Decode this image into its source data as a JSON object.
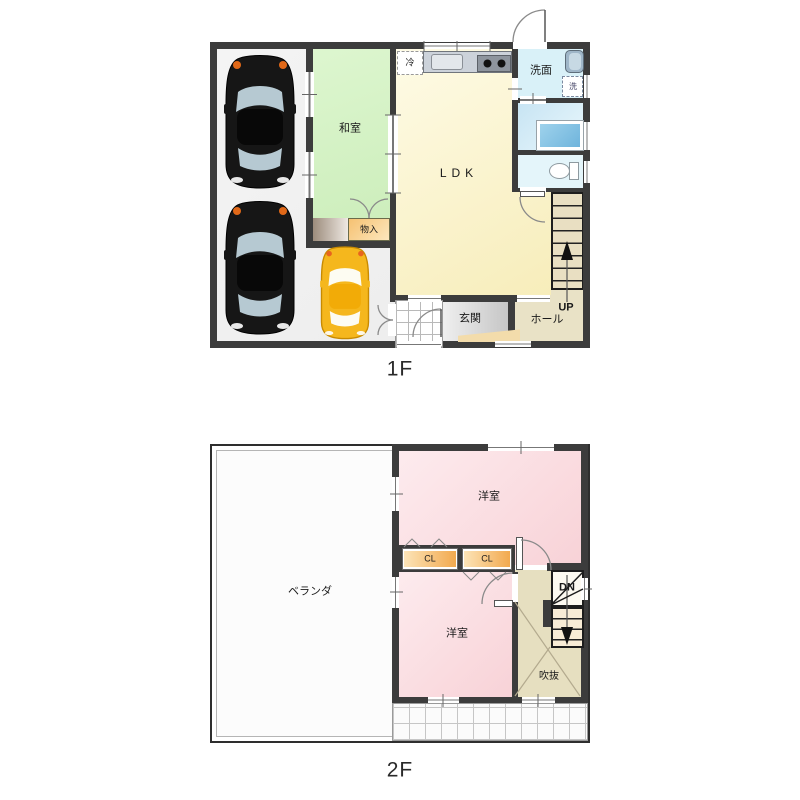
{
  "floor1": {
    "label": "1F",
    "washitsu": "和室",
    "ldk": "LDK",
    "monoire": "物入",
    "fridge": "冷",
    "senmen": "洗面",
    "washer": "洗",
    "genkan": "玄関",
    "hall": "ホール",
    "up": "UP"
  },
  "floor2": {
    "label": "2F",
    "yoshitsu_top": "洋室",
    "yoshitsu_bottom": "洋室",
    "cl1": "CL",
    "cl2": "CL",
    "veranda": "ベランダ",
    "fukinuke": "吹抜",
    "dn": "DN"
  },
  "colors": {
    "wall": "#3c3c3c",
    "washitsu_green": "#d5f3c6",
    "ldk_yellow": "#f8efc2",
    "senmen_cyan": "#d9f1f8",
    "bath_blue": "#cfe7f4",
    "toilet_cyan": "#e4f5fa",
    "stair_tan": "#e7dfc2",
    "genkan_gray": "#d6d6d6",
    "closet_orange": "#f5c478",
    "yoshitsu_pink": "#fad9de",
    "car_black": "#161616",
    "car_yellow": "#f5b71d"
  }
}
